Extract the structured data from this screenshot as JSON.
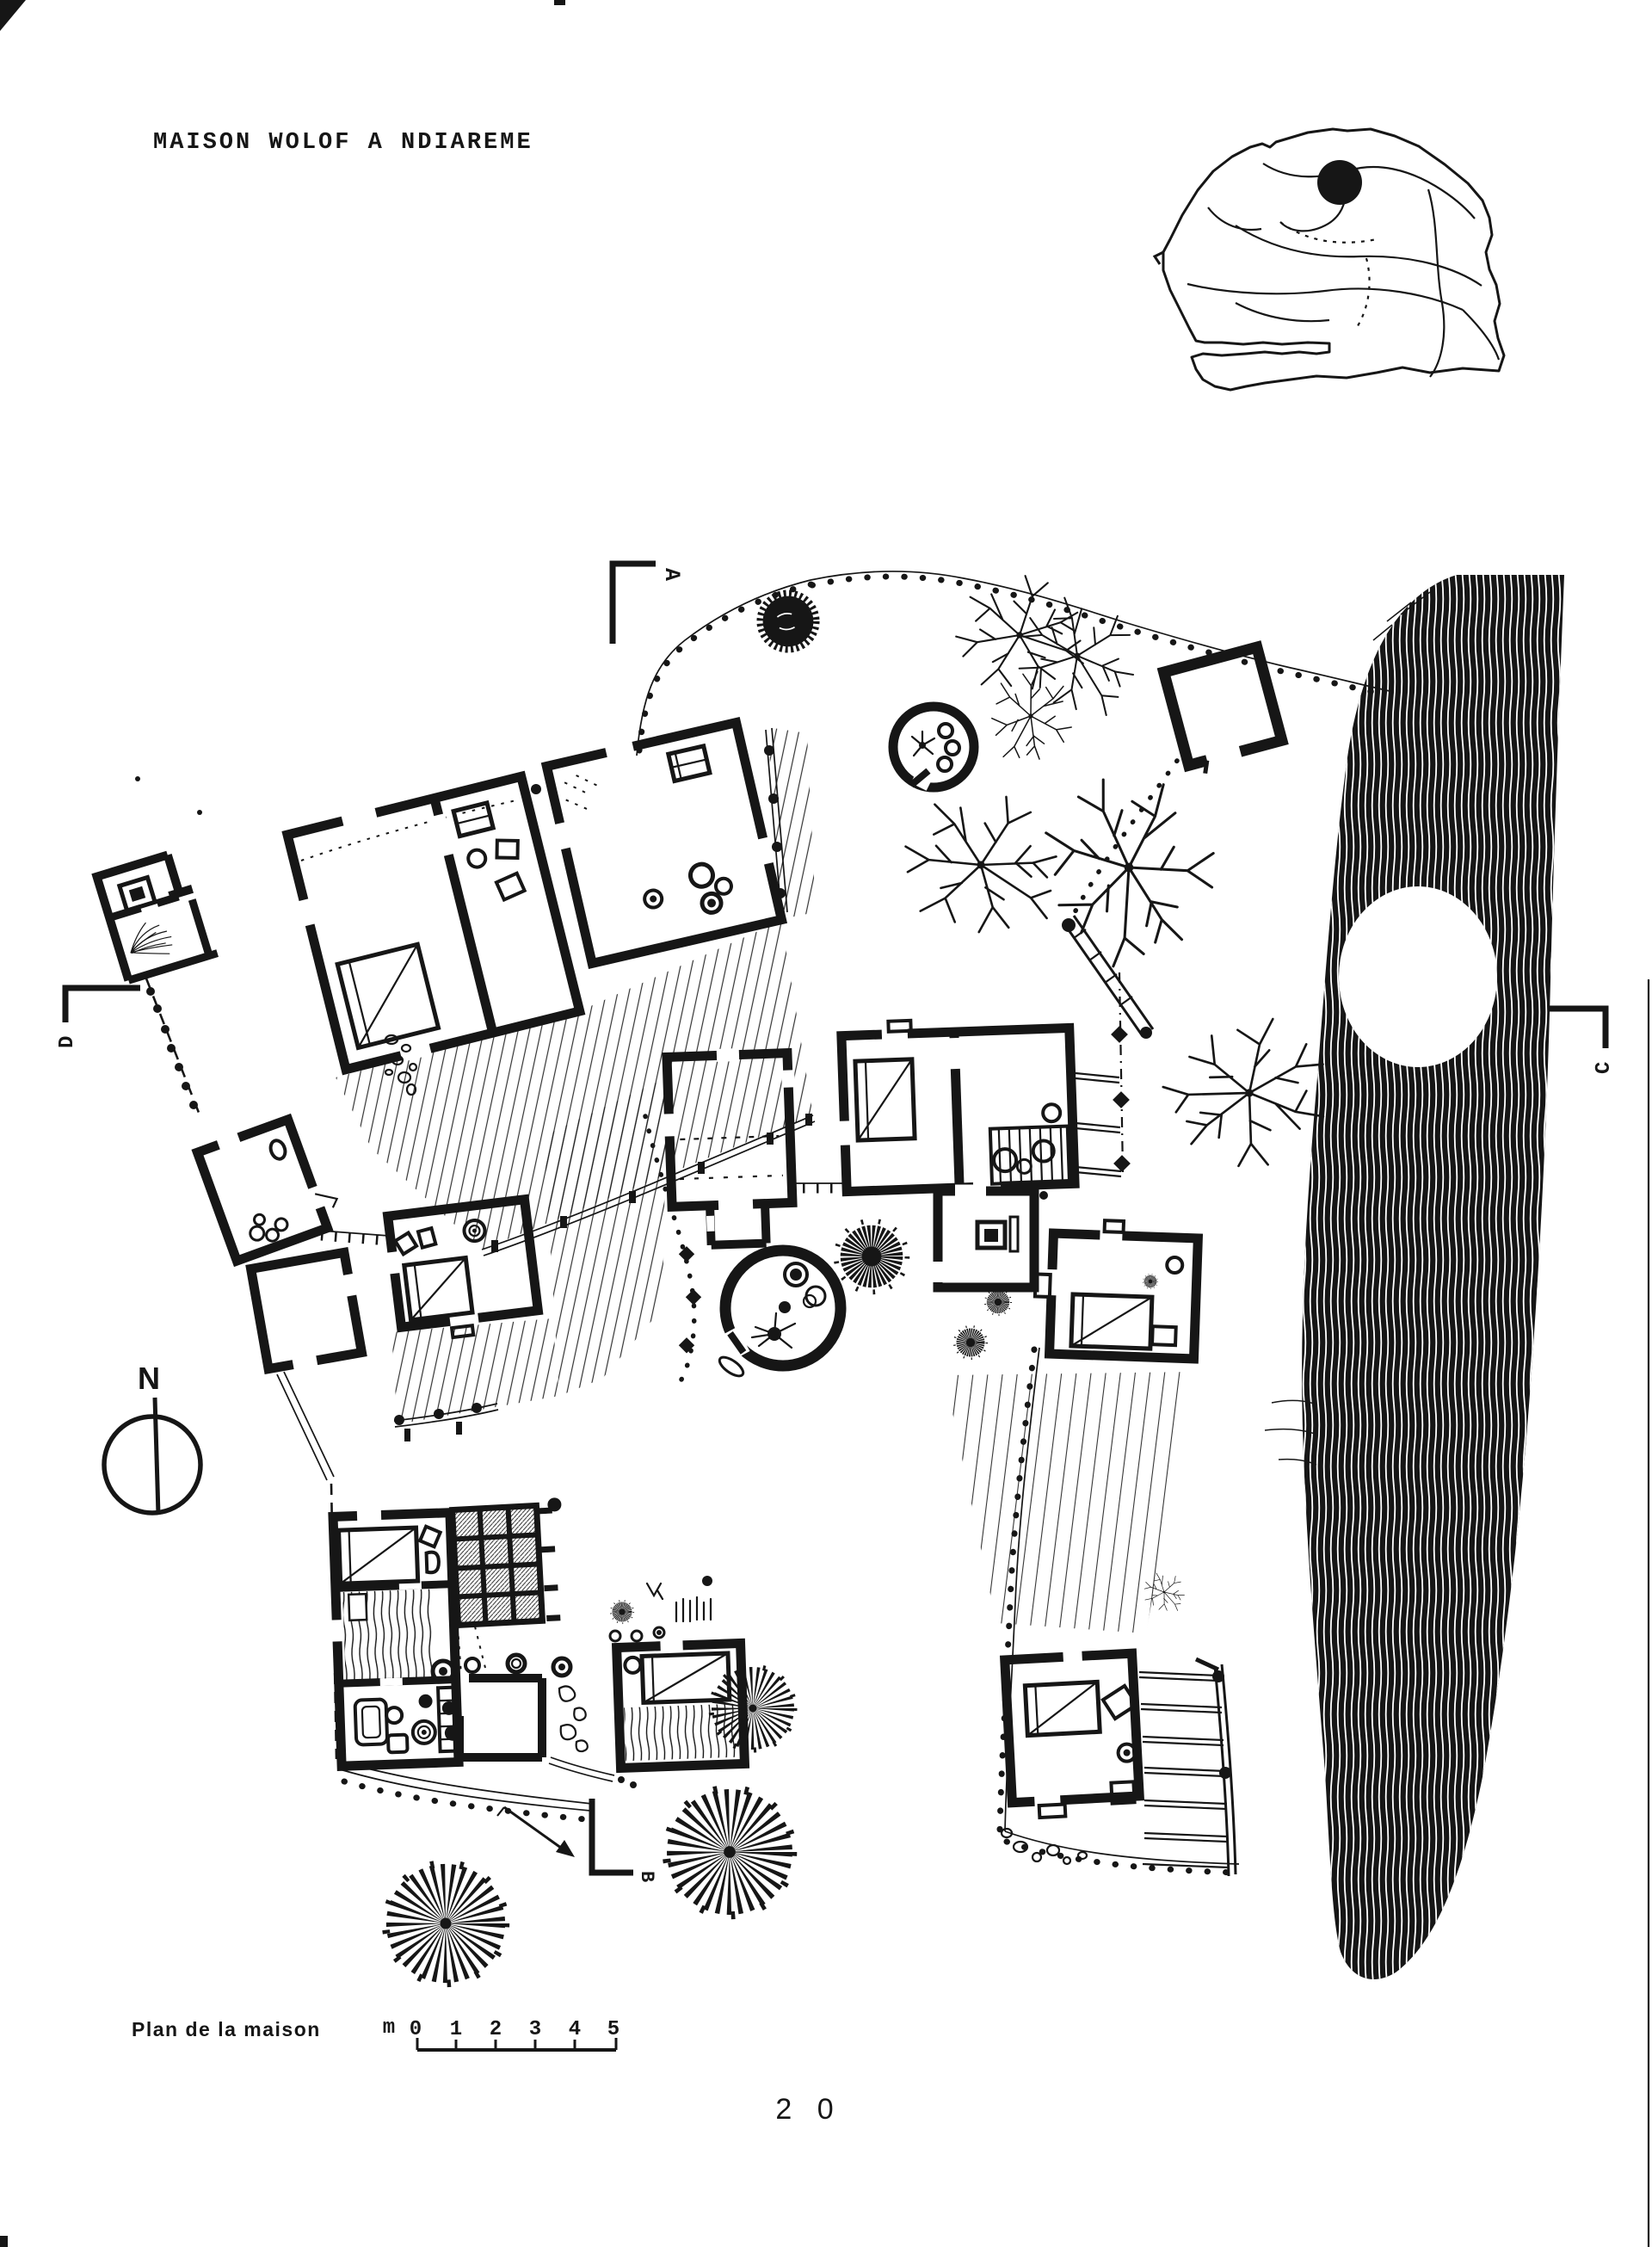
{
  "page": {
    "background": "#ffffff",
    "ink": "#161616",
    "page_number": "2 0"
  },
  "title": "MAISON WOLOF A NDIAREME",
  "section_markers": {
    "a": "A",
    "b": "B",
    "c": "C",
    "d": "D"
  },
  "north_indicator": {
    "label": "N"
  },
  "scale_bar": {
    "caption": "Plan de la maison",
    "unit_prefix": "m",
    "ticks": [
      "0",
      "1",
      "2",
      "3",
      "4",
      "5"
    ]
  }
}
